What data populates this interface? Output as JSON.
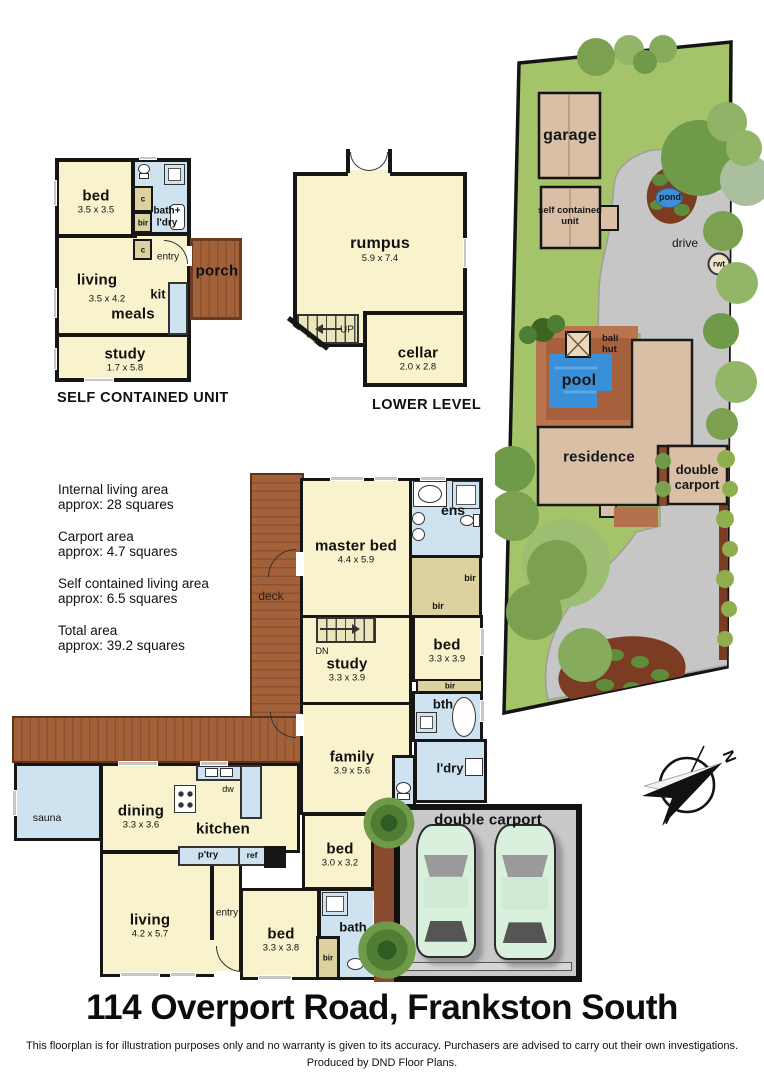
{
  "title": "114 Overport Road, Frankston South",
  "disclaimer": {
    "line1": "This floorplan is for illustration purposes only and no warranty is given to its accuracy. Purchasers are advised to carry out their own investigations.",
    "line2": "Produced by DND Floor Plans."
  },
  "areas": [
    {
      "label": "Internal living area",
      "value": "approx: 28 squares"
    },
    {
      "label": "Carport area",
      "value": "approx: 4.7 squares"
    },
    {
      "label": "Self contained living area",
      "value": "approx: 6.5 squares"
    },
    {
      "label": "Total area",
      "value": "approx: 39.2 squares"
    }
  ],
  "unit_plan": {
    "caption": "SELF CONTAINED UNIT",
    "bed": {
      "name": "bed",
      "dims": "3.5 x 3.5"
    },
    "bath_line1": "bath+",
    "bath_line2": "l'dry",
    "closet1": "c",
    "bir": "bir",
    "closet2": "c",
    "entry": "entry",
    "living": {
      "name": "living",
      "dims": "3.5 x 4.2"
    },
    "kit": "kit",
    "meals": "meals",
    "study": {
      "name": "study",
      "dims": "1.7 x 5.8"
    },
    "porch": "porch"
  },
  "lower_level": {
    "caption": "LOWER LEVEL",
    "rumpus": {
      "name": "rumpus",
      "dims": "5.9 x 7.4"
    },
    "cellar": {
      "name": "cellar",
      "dims": "2.0 x 2.8"
    },
    "up": "UP"
  },
  "site_plan": {
    "garage": "garage",
    "unit_line1": "self contained",
    "unit_line2": "unit",
    "drive": "drive",
    "pond": "pond",
    "rwt": "rwt",
    "bali_line1": "bali",
    "bali_line2": "hut",
    "pool": "pool",
    "residence": "residence",
    "carport_line1": "double",
    "carport_line2": "carport"
  },
  "main_plan": {
    "deck": "deck",
    "master_bed": {
      "name": "master bed",
      "dims": "4.4 x 5.9"
    },
    "ens": "ens",
    "bir_wir": "bir",
    "bir_master": "bir",
    "dn": "DN",
    "study": {
      "name": "study",
      "dims": "3.3 x 3.9"
    },
    "bed1": {
      "name": "bed",
      "dims": "3.3 x 3.9"
    },
    "bir_bed1": "bir",
    "bth": "bth",
    "family": {
      "name": "family",
      "dims": "3.9 x 5.6"
    },
    "ldry": "l'dry",
    "sauna": "sauna",
    "dining": {
      "name": "dining",
      "dims": "3.3 x 3.6"
    },
    "kitchen": "kitchen",
    "dw": "dw",
    "ptry": "p'try",
    "ref": "ref",
    "living": {
      "name": "living",
      "dims": "4.2 x 5.7"
    },
    "entry": "entry",
    "bed2": {
      "name": "bed",
      "dims": "3.0 x 3.2"
    },
    "bed3": {
      "name": "bed",
      "dims": "3.3 x 3.8"
    },
    "bir_bed3": "bir",
    "bath": "bath",
    "double_carport": "double carport"
  },
  "compass": {
    "north": "N"
  }
}
